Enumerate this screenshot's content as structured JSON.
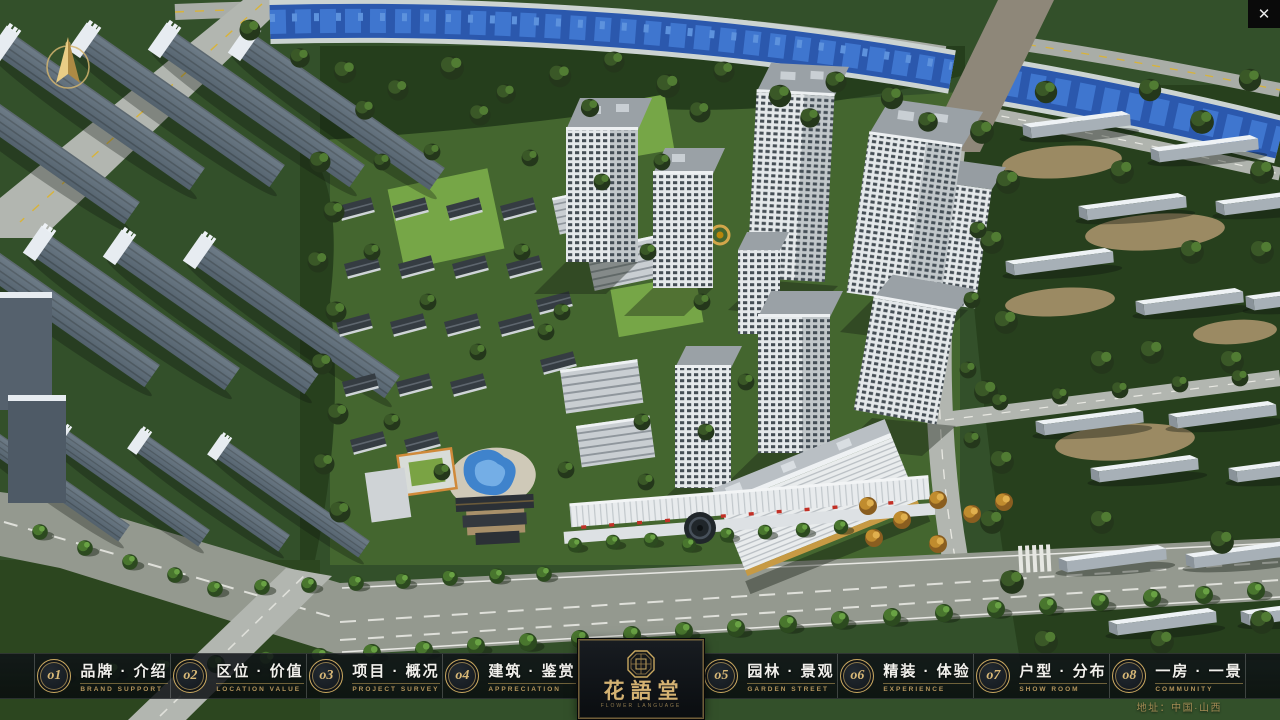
{
  "window": {
    "close_label": "✕"
  },
  "colors": {
    "accent_gold": "#c9a860",
    "bar_bg": "rgba(10,14,18,0.82)",
    "river_blue": "#2b58ad",
    "tree_green": "#33502a"
  },
  "icons": {
    "compass": "compass-north-arrow",
    "close": "close-x",
    "seal": "logo-seal-emblem"
  },
  "scene": {
    "description_label": ""
  },
  "logo": {
    "name": "花語堂",
    "subtitle": "FLOWER LANGUAGE"
  },
  "nav": {
    "items": [
      {
        "num": "o1",
        "label": "品牌 · 介绍",
        "sub": "BRAND SUPPORT"
      },
      {
        "num": "o2",
        "label": "区位 · 价值",
        "sub": "LOCATION VALUE"
      },
      {
        "num": "o3",
        "label": "项目 · 概况",
        "sub": "PROJECT SURVEY"
      },
      {
        "num": "o4",
        "label": "建筑 · 鉴赏",
        "sub": "APPRECIATION"
      },
      {
        "num": "o5",
        "label": "园林 · 景观",
        "sub": "GARDEN STREET"
      },
      {
        "num": "o6",
        "label": "精装 · 体验",
        "sub": "EXPERIENCE"
      },
      {
        "num": "o7",
        "label": "户型 · 分布",
        "sub": "SHOW ROOM"
      },
      {
        "num": "o8",
        "label": "一房 · 一景",
        "sub": "COMMUNITY"
      }
    ]
  },
  "footer": {
    "address": "地址：中国·山西"
  }
}
